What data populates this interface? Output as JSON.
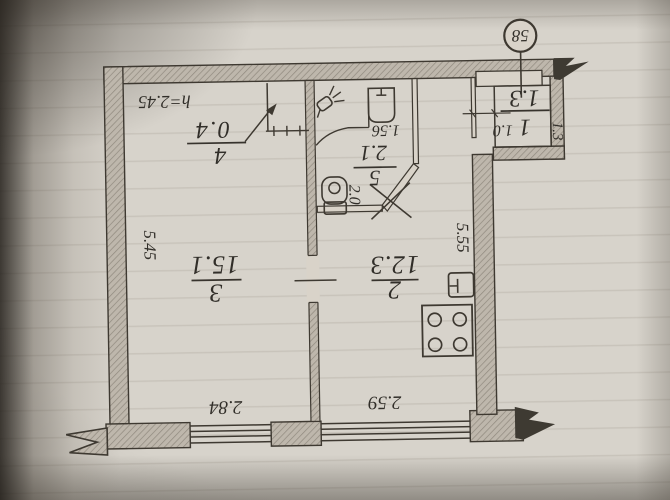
{
  "plan": {
    "apartment_number_label": "58",
    "ceiling_height": "h=2.45",
    "rooms": {
      "living": {
        "number": "3",
        "area": "15.1",
        "width_dim": "2.84",
        "depth_dim": "5.45"
      },
      "kitchen": {
        "number": "2",
        "area": "12.3",
        "width_dim": "2.59",
        "depth_dim": "5.55"
      },
      "sanitary": {
        "number": "5",
        "area": "2.1",
        "basin_dim": "1.56",
        "side_dim": "2.0"
      },
      "closet": {
        "number": "4",
        "area": "0.4"
      },
      "hall": {
        "number": "1",
        "area": "1.3",
        "width_dim": "1.0",
        "side_dim": "1.3"
      }
    }
  }
}
